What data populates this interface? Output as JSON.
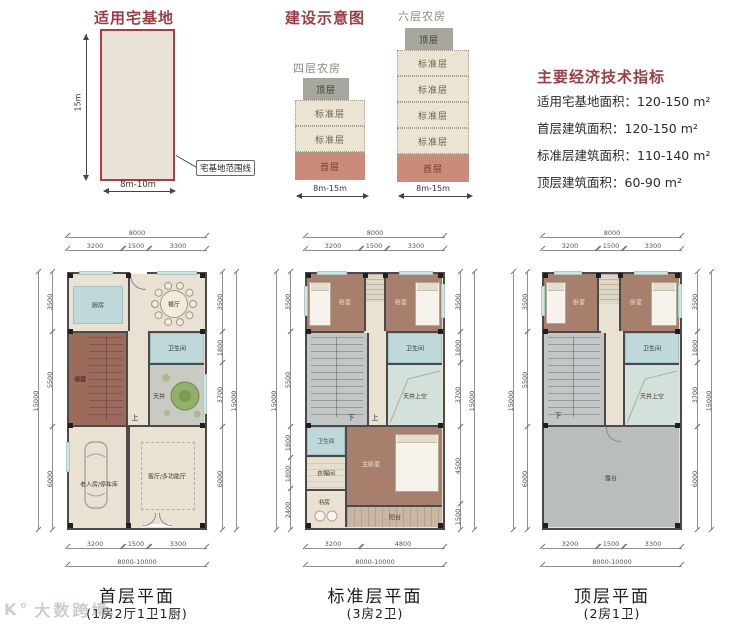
{
  "site": {
    "title": "适用宅基地",
    "height_label": "15m",
    "width_label": "8m-10m",
    "boundary_label": "宅基地范围线"
  },
  "schematic": {
    "title": "建设示意图",
    "towers": [
      {
        "name": "四层农房",
        "width_label": "8m-15m",
        "floors": [
          "顶层",
          "标准层",
          "标准层",
          "首层"
        ]
      },
      {
        "name": "六层农房",
        "width_label": "8m-15m",
        "floors": [
          "顶层",
          "标准层",
          "标准层",
          "标准层",
          "标准层",
          "首层"
        ]
      }
    ]
  },
  "indicators": {
    "title": "主要经济技术指标",
    "items": [
      "适用宅基地面积：120-150 m²",
      "首层建筑面积：120-150 m²",
      "标准层建筑面积：110-140 m²",
      "顶层建筑面积：60-90 m²"
    ]
  },
  "plans": [
    {
      "caption": "首层平面",
      "subtitle": "(1房2厅1卫1厨)",
      "dims": {
        "top_total": "8000",
        "top": [
          "3200",
          "1500",
          "3300"
        ],
        "bottom": [
          "3200",
          "1500",
          "3300"
        ],
        "bottom_total": "8000-10000",
        "left": [
          "3500",
          "5500",
          "6000"
        ],
        "left_total": "15000",
        "right": [
          "3500",
          "1800",
          "3700",
          "6000"
        ],
        "right_total": "15000"
      },
      "rooms": {
        "kitchen": "厨房",
        "dining": "餐厅",
        "storage": "储藏",
        "bath": "卫生间",
        "courtyard": "天井",
        "elder": "老人房/停车库",
        "living": "客厅/多功能厅",
        "up": "上"
      }
    },
    {
      "caption": "标准层平面",
      "subtitle": "(3房2卫)",
      "dims": {
        "top_total": "8000",
        "top": [
          "3200",
          "1500",
          "3300"
        ],
        "bottom": [
          "3200",
          "4800"
        ],
        "bottom_total": "8000-10000",
        "left": [
          "3500",
          "5500",
          "1800",
          "1800",
          "2400"
        ],
        "left_total": "15000",
        "right": [
          "3500",
          "1800",
          "3700",
          "4500",
          "1500"
        ],
        "right_total": "15000"
      },
      "rooms": {
        "bed_left": "卧室",
        "bed_right": "卧室",
        "bath": "卫生间",
        "void": "天井上空",
        "bath2": "卫生间",
        "cloak": "衣帽间",
        "study": "书房",
        "master": "主卧室",
        "balcony": "阳台",
        "down": "下",
        "up": "上"
      }
    },
    {
      "caption": "顶层平面",
      "subtitle": "(2房1卫)",
      "dims": {
        "top_total": "8000",
        "top": [
          "3200",
          "1500",
          "3300"
        ],
        "bottom": [
          "3200",
          "1500",
          "3300"
        ],
        "bottom_total": "8000-10000",
        "left": [
          "3500",
          "5500",
          "6000"
        ],
        "left_total": "15000",
        "right": [
          "3500",
          "1800",
          "3700",
          "6000"
        ],
        "right_total": "15000"
      },
      "rooms": {
        "bed_left": "卧室",
        "bed_right": "卧室",
        "bath": "卫生间",
        "void": "天井上空",
        "terrace": "露台",
        "down": "下"
      }
    }
  ],
  "watermark": {
    "logo": "K°",
    "text": "大数跨境"
  },
  "colors": {
    "accent": "#993f44",
    "site_border": "#b23a3a",
    "first_floor_block": "#cc8b78",
    "standard_floor_block": "#ece4d2",
    "top_floor_block": "#a7a79f"
  }
}
